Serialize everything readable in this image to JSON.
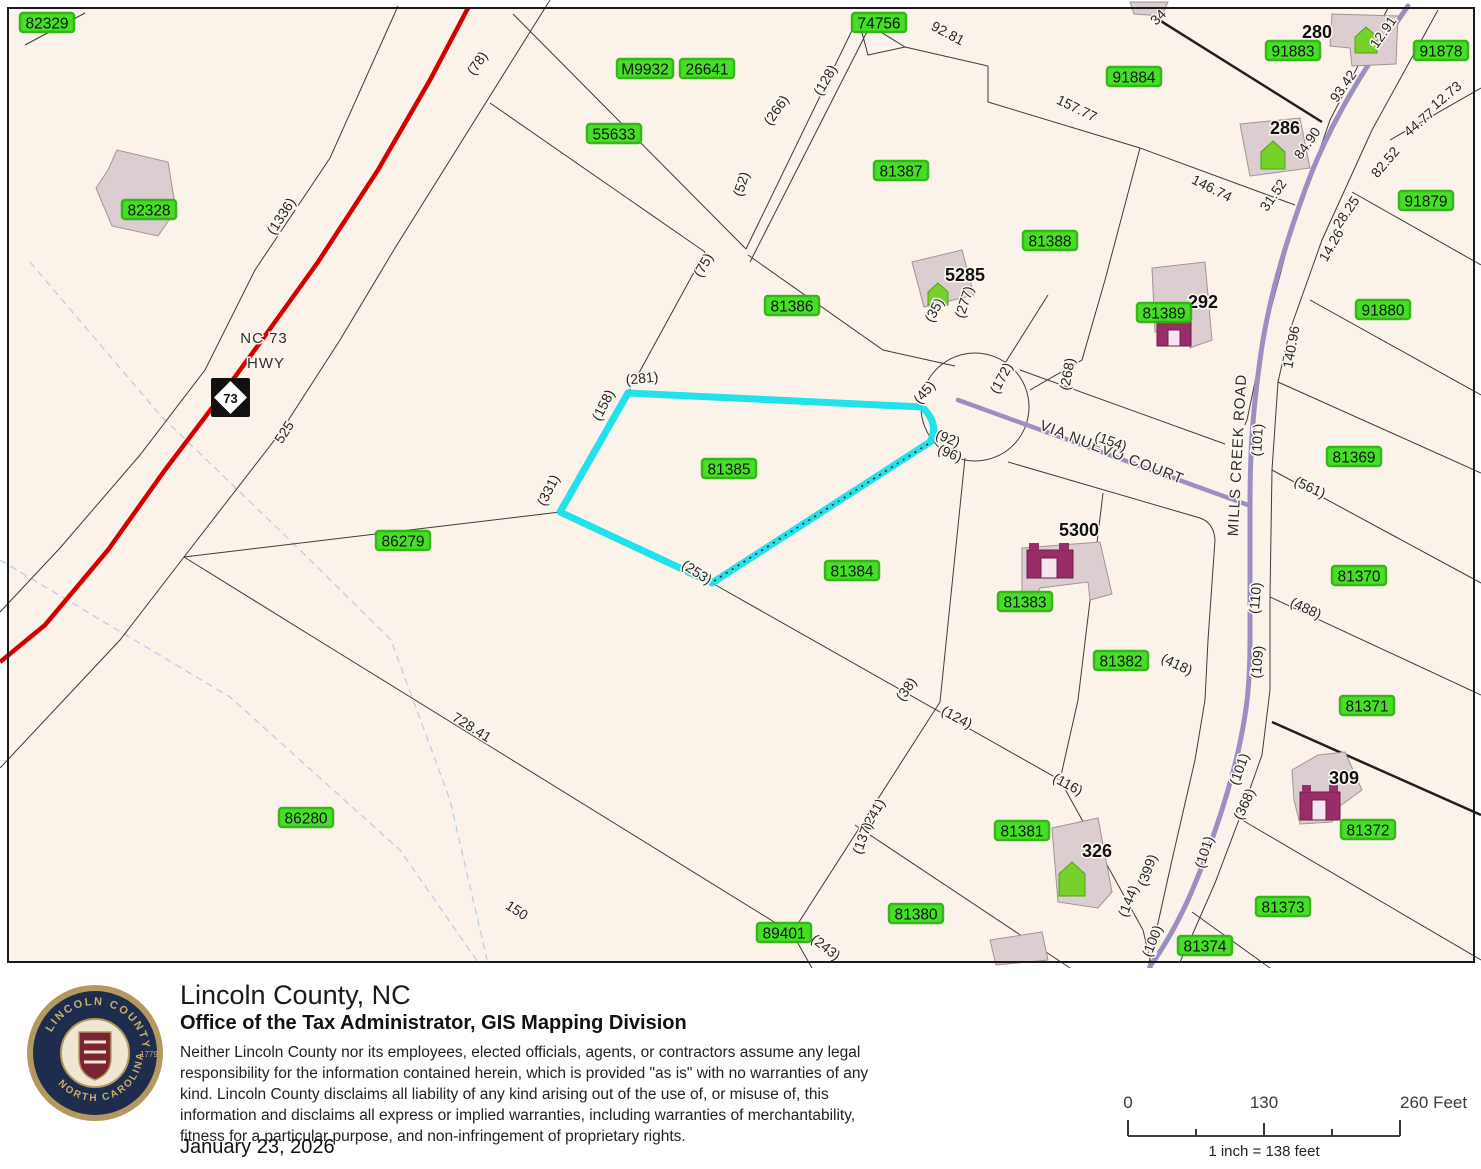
{
  "m": {
    "green": [
      "82329",
      "82328",
      "M9932",
      "26641",
      "55633",
      "74756",
      "91884",
      "91883",
      "91878",
      "81387",
      "91879",
      "81388",
      "81389",
      "91880",
      "81386",
      "81385",
      "81369",
      "86279",
      "81384",
      "81383",
      "81370",
      "81382",
      "81371",
      "86280",
      "81381",
      "81372",
      "81380",
      "81373",
      "81374",
      "89401"
    ],
    "houses": [
      "280",
      "286",
      "292",
      "5285",
      "5300",
      "326",
      "309"
    ],
    "dims": [
      "(78)",
      "(1336)",
      "525",
      "(266)",
      "(128)",
      "92.81",
      "(52)",
      "(75)",
      "157.77",
      "146.74",
      "(35)",
      "(277)",
      "93.42",
      "12.91",
      "84.90",
      "31.52",
      "44.77",
      "12.73",
      "82.52",
      "28.25",
      "14.26",
      "140.96",
      "(101)",
      "(561)",
      "(110)",
      "(488)",
      "(109)",
      "(172)",
      "(268)",
      "(96)",
      "(45)",
      "(92)",
      "(154)",
      "(281)",
      "(158)",
      "(331)",
      "(253)",
      "(38)",
      "(124)",
      "(116)",
      "(241)",
      "(137)",
      "(418)",
      "(399)",
      "(144)",
      "(100)",
      "(368)",
      "(101)",
      "(101)",
      "(243)",
      "728.41",
      "150",
      "34"
    ],
    "roads": {
      "nc73a": "NC 73",
      "nc73b": "HWY",
      "shield": "73",
      "via": "VIA NUEVO COURT",
      "mills": "MILLS CREEK ROAD"
    },
    "colors": {
      "highlight_green": "#3ce01c",
      "selection_cyan": "#0ee0ea",
      "road_red": "#d40000",
      "road_purple": "#9b8fc2",
      "building_fill": "#dccdd0",
      "map_bg": "#fbf2e9"
    }
  },
  "footer": {
    "title": "Lincoln County, NC",
    "subtitle": "Office of the Tax Administrator, GIS Mapping Division",
    "disclaimer1": "Neither Lincoln County nor its employees, elected officials, agents, or contractors assume any legal",
    "disclaimer2": "responsibility for the information contained herein, which is provided \"as is\" with no warranties of any",
    "disclaimer3": "kind. Lincoln County disclaims all liability of any kind arising out of the use of, or misuse of, this",
    "disclaimer4": "information and disclaims all express or implied warranties, including warranties of merchantability,",
    "disclaimer5": "fitness for a particular purpose, and non-infringement of  proprietary rights.",
    "date": "January 23, 2026",
    "logo_top": "LINCOLN COUNTY",
    "logo_bottom": "NORTH CAROLINA",
    "logo_year": "1779",
    "scale": {
      "t0": "0",
      "t130": "130",
      "t260": "260 Feet",
      "ratio": "1 inch = 138 feet"
    }
  }
}
